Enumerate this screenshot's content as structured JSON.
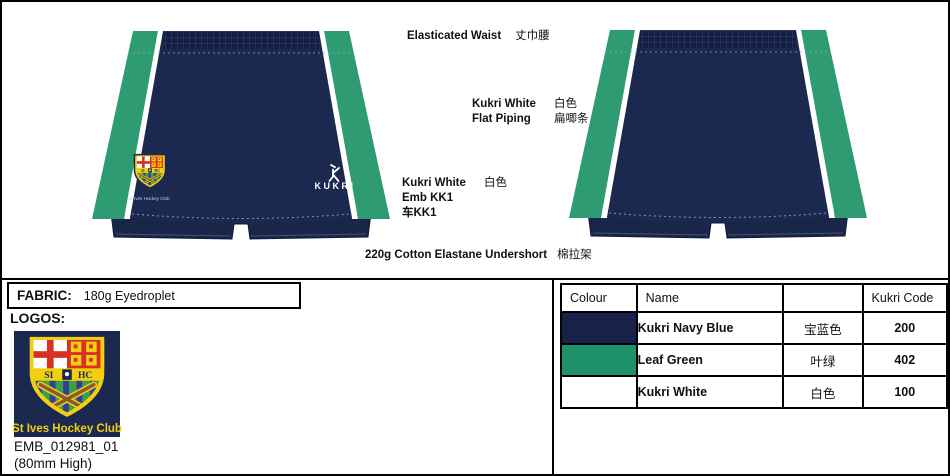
{
  "annotations": {
    "elasticated_waist": {
      "en": "Elasticated Waist",
      "zh": "丈巾腰"
    },
    "flat_piping": {
      "line1_en": "Kukri White",
      "line1_zh": "白色",
      "line2_en": "Flat Piping",
      "line2_zh": "扁唧条"
    },
    "emb": {
      "line1_en": "Kukri White",
      "line1_zh": "白色",
      "line2": "Emb KK1",
      "line3": "车KK1"
    },
    "undershort": {
      "en": "220g Cotton Elastane Undershort",
      "zh": "棉拉架"
    }
  },
  "fabric": {
    "label": "FABRIC:",
    "value": "180g Eyedroplet"
  },
  "logos": {
    "label": "LOGOS:",
    "club_name": "St Ives Hockey Club",
    "emb_code": "EMB_012981_01",
    "size_note": "(80mm High)"
  },
  "crest": {
    "si": "SI",
    "hc": "HC"
  },
  "shorts": {
    "kukri_wordmark": "KUKRI",
    "club_text": "St Ives Hockey Club"
  },
  "colour_table": {
    "header": {
      "colour": "Colour",
      "name": "Name",
      "zh": "",
      "code": "Kukri Code"
    },
    "rows": [
      {
        "swatch": "#17214a",
        "name": "Kukri Navy Blue",
        "zh": "宝蓝色",
        "code": "200"
      },
      {
        "swatch": "#1d9168",
        "name": "Leaf Green",
        "zh": "叶绿",
        "code": "402"
      },
      {
        "swatch": "#ffffff",
        "name": "Kukri White",
        "zh": "白色",
        "code": "100"
      }
    ]
  },
  "colors": {
    "navy": "#1b2950",
    "waistband_navy": "#141f42",
    "green": "#2e9b73",
    "white": "#ffffff",
    "crest_yellow": "#f3cf12",
    "crest_red": "#d93025",
    "crest_green": "#3aa048",
    "crest_stripe_blue": "#333f8f"
  }
}
